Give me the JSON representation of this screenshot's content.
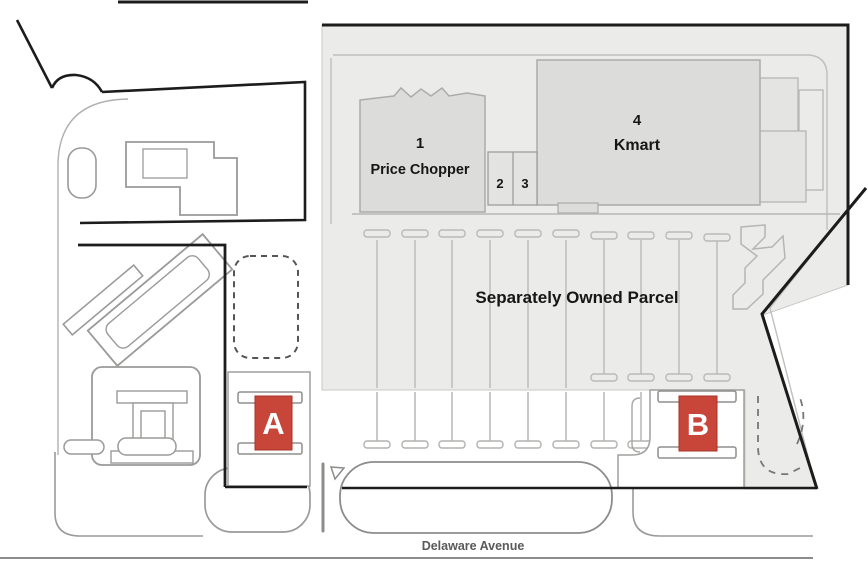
{
  "site_plan": {
    "parcel": {
      "label": "Separately Owned Parcel"
    },
    "street": {
      "name": "Delaware Avenue"
    },
    "buildings": {
      "price_chopper": {
        "number": "1",
        "name": "Price Chopper"
      },
      "unit_2": {
        "number": "2"
      },
      "unit_3": {
        "number": "3"
      },
      "kmart": {
        "number": "4",
        "name": "Kmart"
      },
      "pad_a": {
        "letter": "A"
      },
      "pad_b": {
        "letter": "B"
      }
    },
    "colors": {
      "pad_marker_red": "#c8453a",
      "parcel_fill": "#ebebea",
      "building_fill": "#dcdcdb",
      "boundary_black": "#1c1c1c"
    }
  }
}
